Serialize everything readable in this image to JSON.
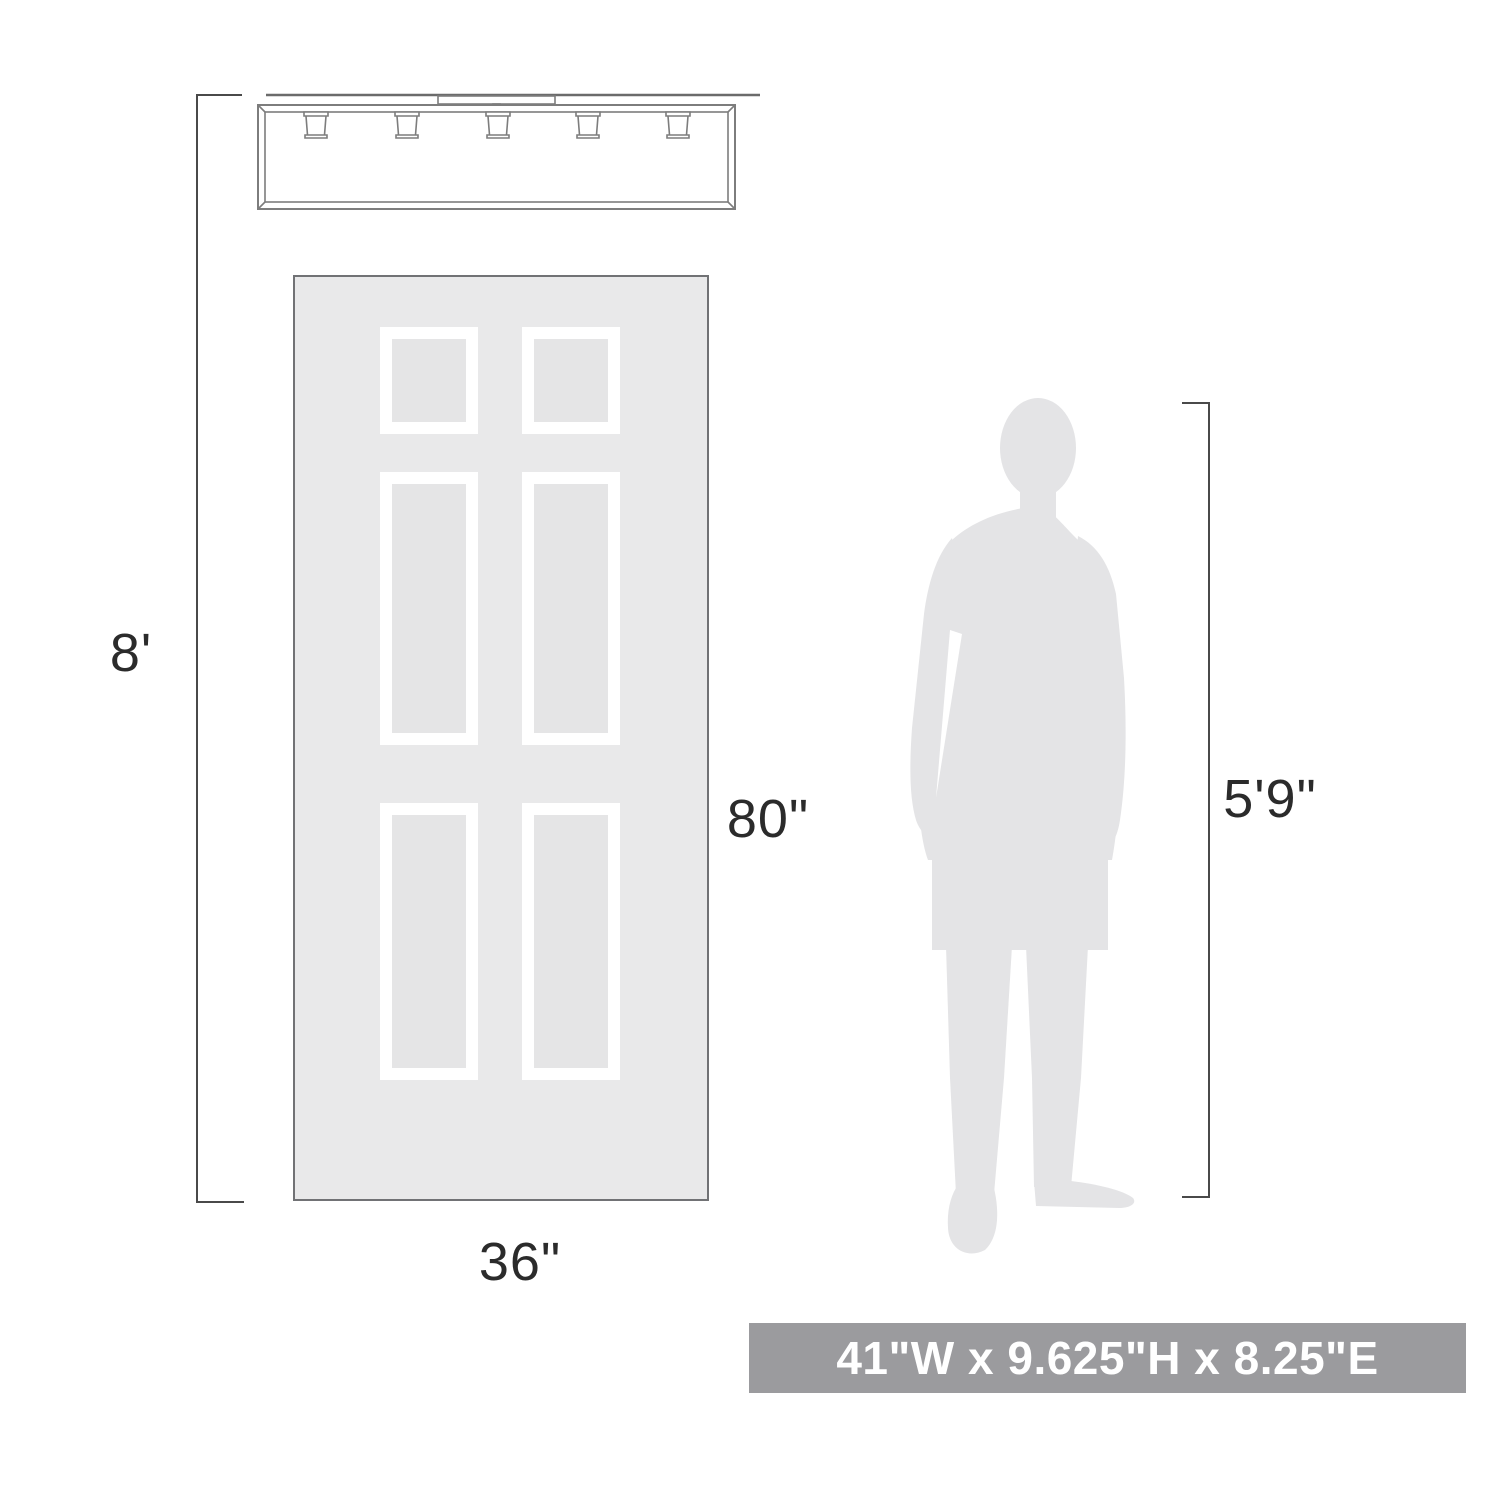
{
  "title": "Lighting fixture scale and dimensions diagram",
  "fixture": {
    "name": "5-light linear flush-mount ceiling fixture line drawing",
    "light_count": 5
  },
  "door": {
    "name": "six-panel door silhouette",
    "panel_count": 6
  },
  "person": {
    "name": "standing man silhouette"
  },
  "dimensions": {
    "ceiling_height_label": "8'",
    "door_height_label": "80\"",
    "door_width_label": "36\"",
    "person_height_label": "5'9\""
  },
  "size_banner": {
    "text": "41\"W x 9.625\"H x 8.25\"E"
  },
  "colors": {
    "background": "#ffffff",
    "line_art": "#7d7d7d",
    "dimension_line": "#4a4a4a",
    "label_text": "#2b2b2b",
    "door_fill": "#e9e9ea",
    "door_border": "#717275",
    "panel_frame": "#ffffff",
    "panel_inner": "#e5e5e6",
    "silhouette": "#e4e4e6",
    "banner_bg": "#9b9b9e",
    "banner_text": "#ffffff"
  }
}
